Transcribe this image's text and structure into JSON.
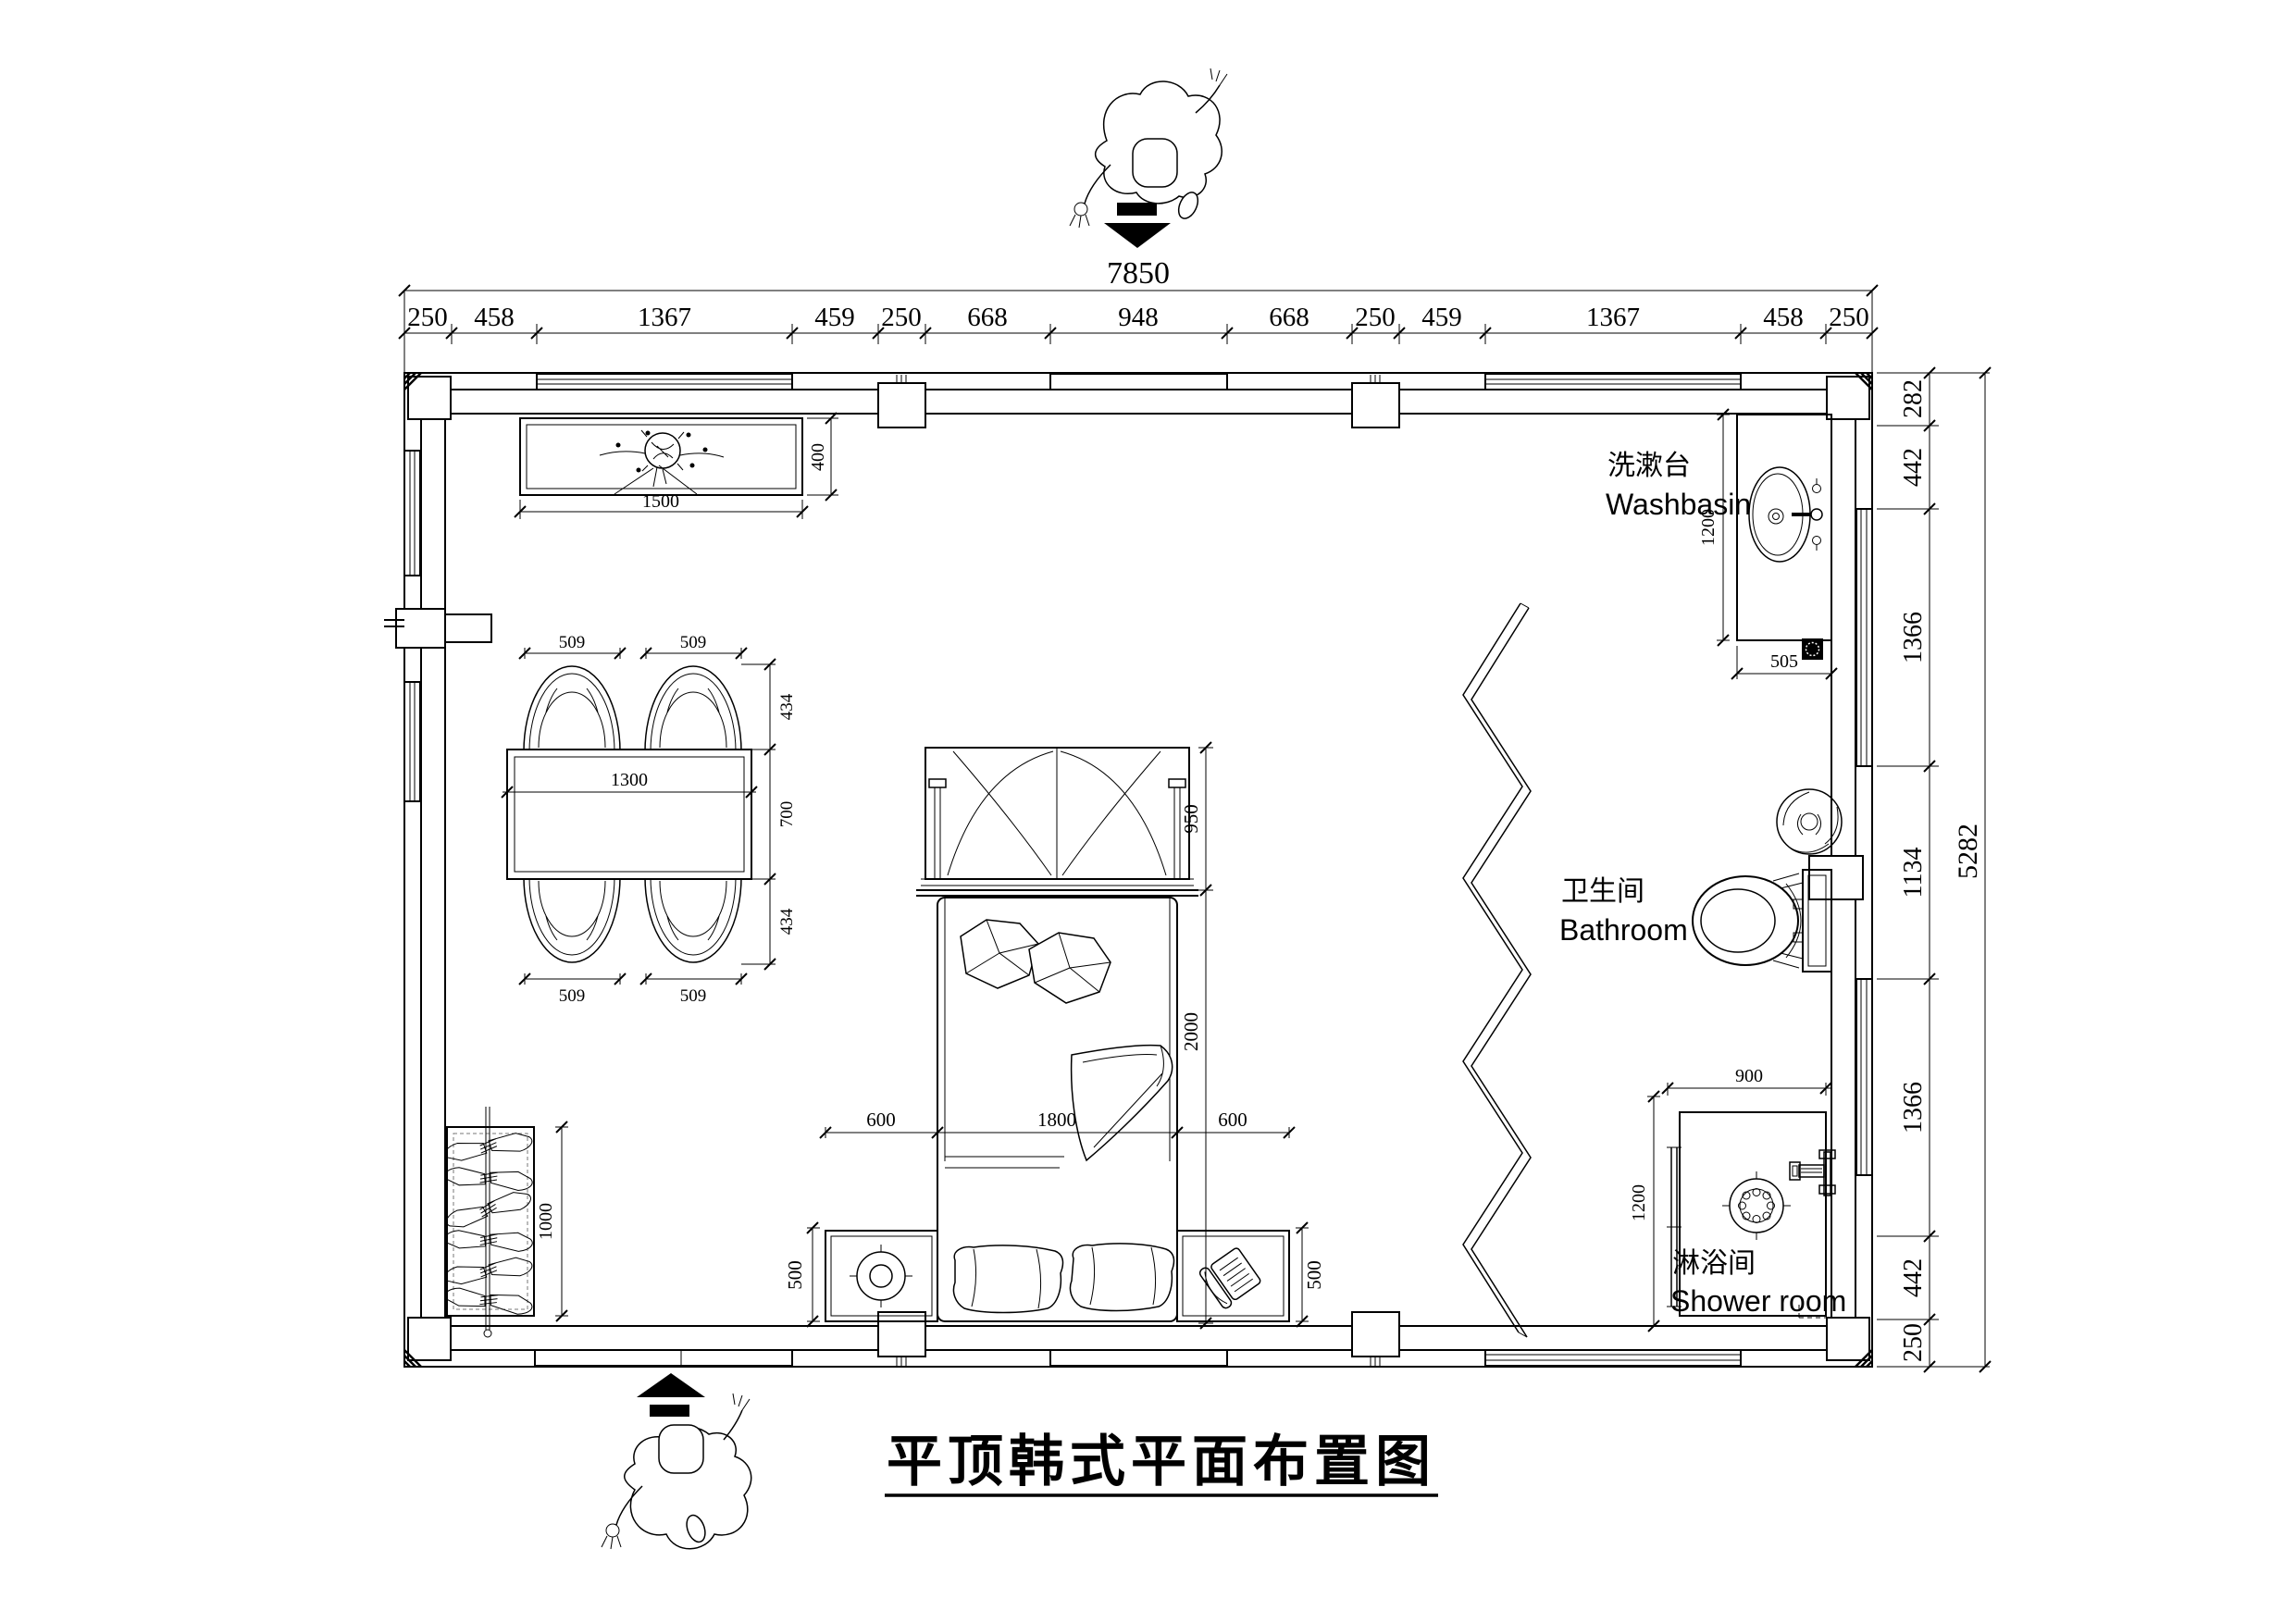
{
  "title": "平顶韩式平面布置图",
  "labels": {
    "washbasin_zh": "洗漱台",
    "washbasin_en": "Washbasin",
    "bathroom_zh": "卫生间",
    "bathroom_en": "Bathroom",
    "shower_zh": "淋浴间",
    "shower_en": "Shower room"
  },
  "dims": {
    "top_total": "7850",
    "top": [
      "250",
      "458",
      "1367",
      "459",
      "250",
      "668",
      "948",
      "668",
      "250",
      "459",
      "1367",
      "458",
      "250"
    ],
    "right": [
      "282",
      "442",
      "1366",
      "1134",
      "1366",
      "442",
      "250"
    ],
    "right_total": "5282",
    "cabinet_w": "1500",
    "cabinet_d": "400",
    "chair_t1": "509",
    "chair_t2": "509",
    "chair_b1": "509",
    "chair_b2": "509",
    "table_w": "1300",
    "side_t": "434",
    "side_m": "700",
    "side_b": "434",
    "bed_l": "600",
    "bed_w": "1800",
    "bed_r": "600",
    "bed_canopy": "950",
    "bed_len": "2000",
    "ns_l": "500",
    "ns_r": "500",
    "wardrobe_h": "1000",
    "basin_d": "1200",
    "basin_w": "505",
    "shower_w": "900",
    "shower_d": "1200"
  }
}
